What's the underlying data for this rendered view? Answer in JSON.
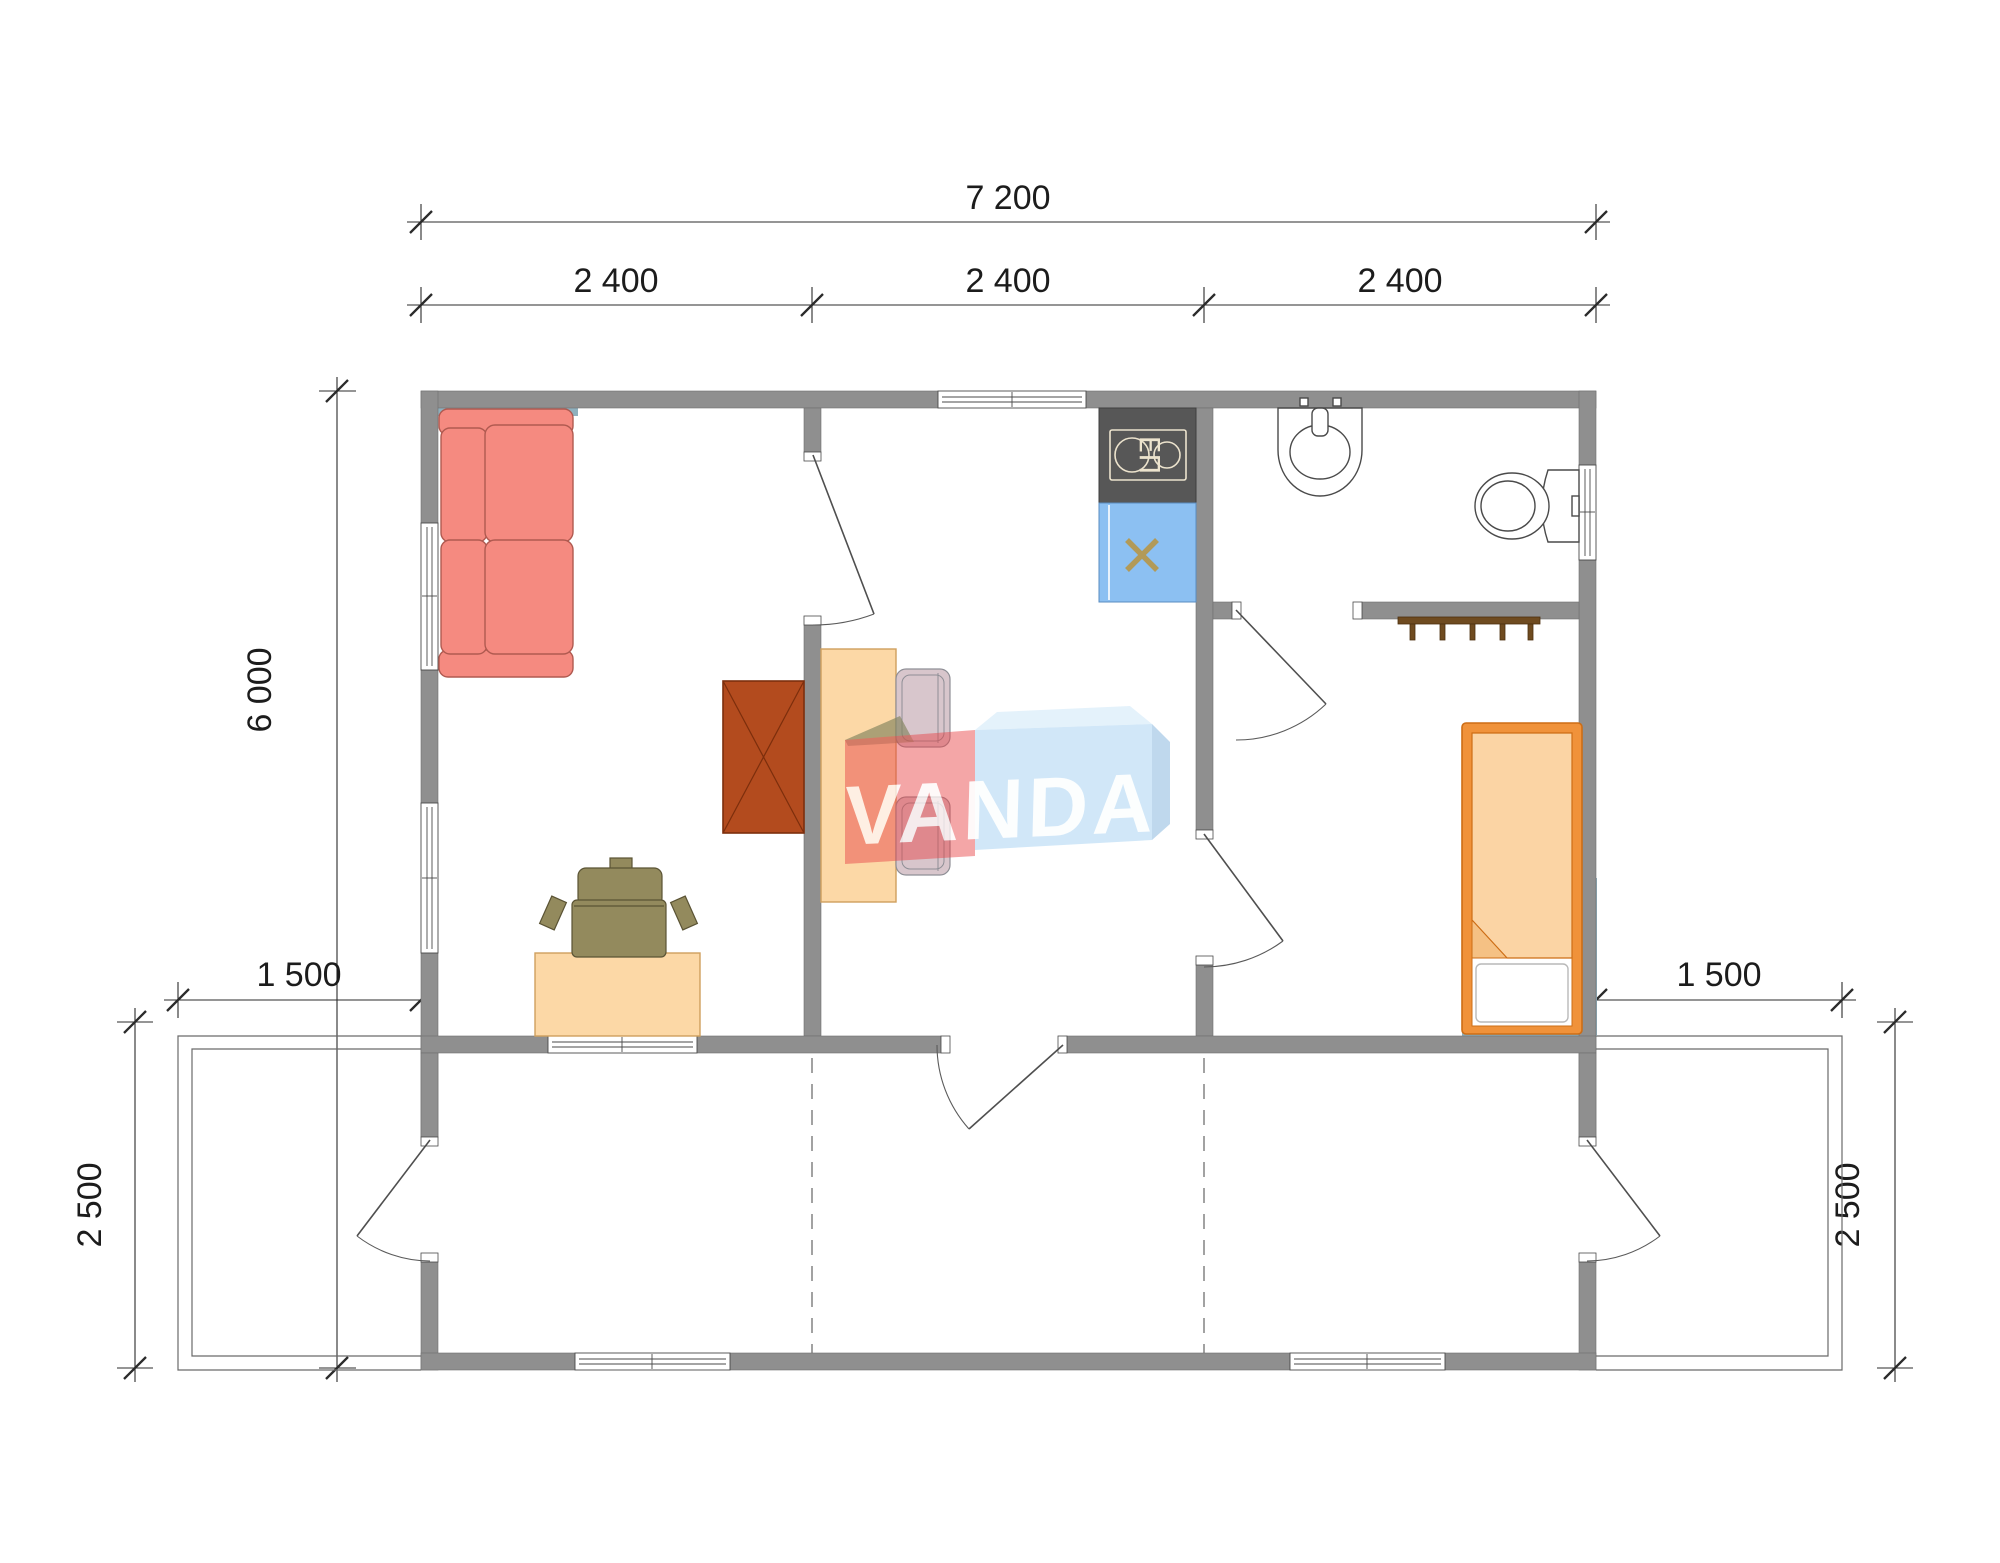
{
  "plan": {
    "title": "prefab-house-floor-plan",
    "dimensions": {
      "top_total": "7 200",
      "top_modules": [
        "2 400",
        "2 400",
        "2 400"
      ],
      "left_total": "6 000",
      "porch_left_width": "1 500",
      "porch_right_width": "1 500",
      "porch_left_depth": "2 500",
      "porch_right_depth": "2 500"
    },
    "watermark": {
      "text": "VANDA"
    },
    "kitchen": {
      "stove_label": "ЕП"
    },
    "rooms": [
      "living-room",
      "kitchen-dining",
      "bathroom",
      "bedroom",
      "veranda"
    ],
    "furniture": [
      "corner-sofa",
      "desk",
      "office-chair",
      "wardrobe",
      "dining-table",
      "dining-chair",
      "dining-chair",
      "stove",
      "kitchen-sink",
      "wash-basin",
      "toilet",
      "coat-hanger",
      "single-bed"
    ],
    "colors": {
      "wall": "#8f8f8f",
      "accent_shadow": "#8fb0bd",
      "sofa": "#f58a80",
      "sofa_stroke": "#b05a50",
      "desk": "#fcd8a6",
      "chair_office": "#938a5d",
      "chair_dining": "#d8c6cc",
      "wardrobe": "#b34b1e",
      "bed_frame": "#f0923a",
      "bed_blanket": "#fbd4a4",
      "stove": "#575757",
      "sink": "#8cc0f2",
      "sink_cross": "#b29a58",
      "hanger": "#6f4b20",
      "logo_red": "#e64549",
      "logo_blue": "#badcf5",
      "dim_text": "#1c1c1c"
    }
  }
}
